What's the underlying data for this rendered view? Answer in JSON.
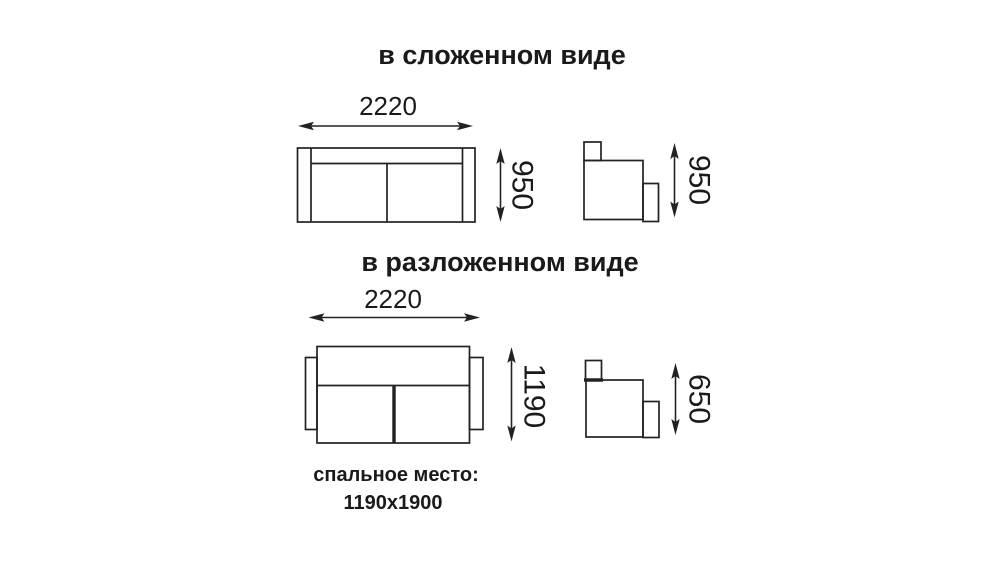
{
  "diagram": {
    "subject": "sofa-dimension-drawing",
    "sections": [
      {
        "title": "в сложенном виде",
        "width": "2220",
        "front_height": "950",
        "side_height": "950"
      },
      {
        "title": "в разложенном виде",
        "width": "2220",
        "front_depth": "1190",
        "side_height": "650"
      }
    ],
    "footer": {
      "label": "спальное место:",
      "size": "1190x1900"
    },
    "colors": {
      "line": "#222222",
      "text": "#1a1a1a",
      "background": "#ffffff"
    }
  }
}
